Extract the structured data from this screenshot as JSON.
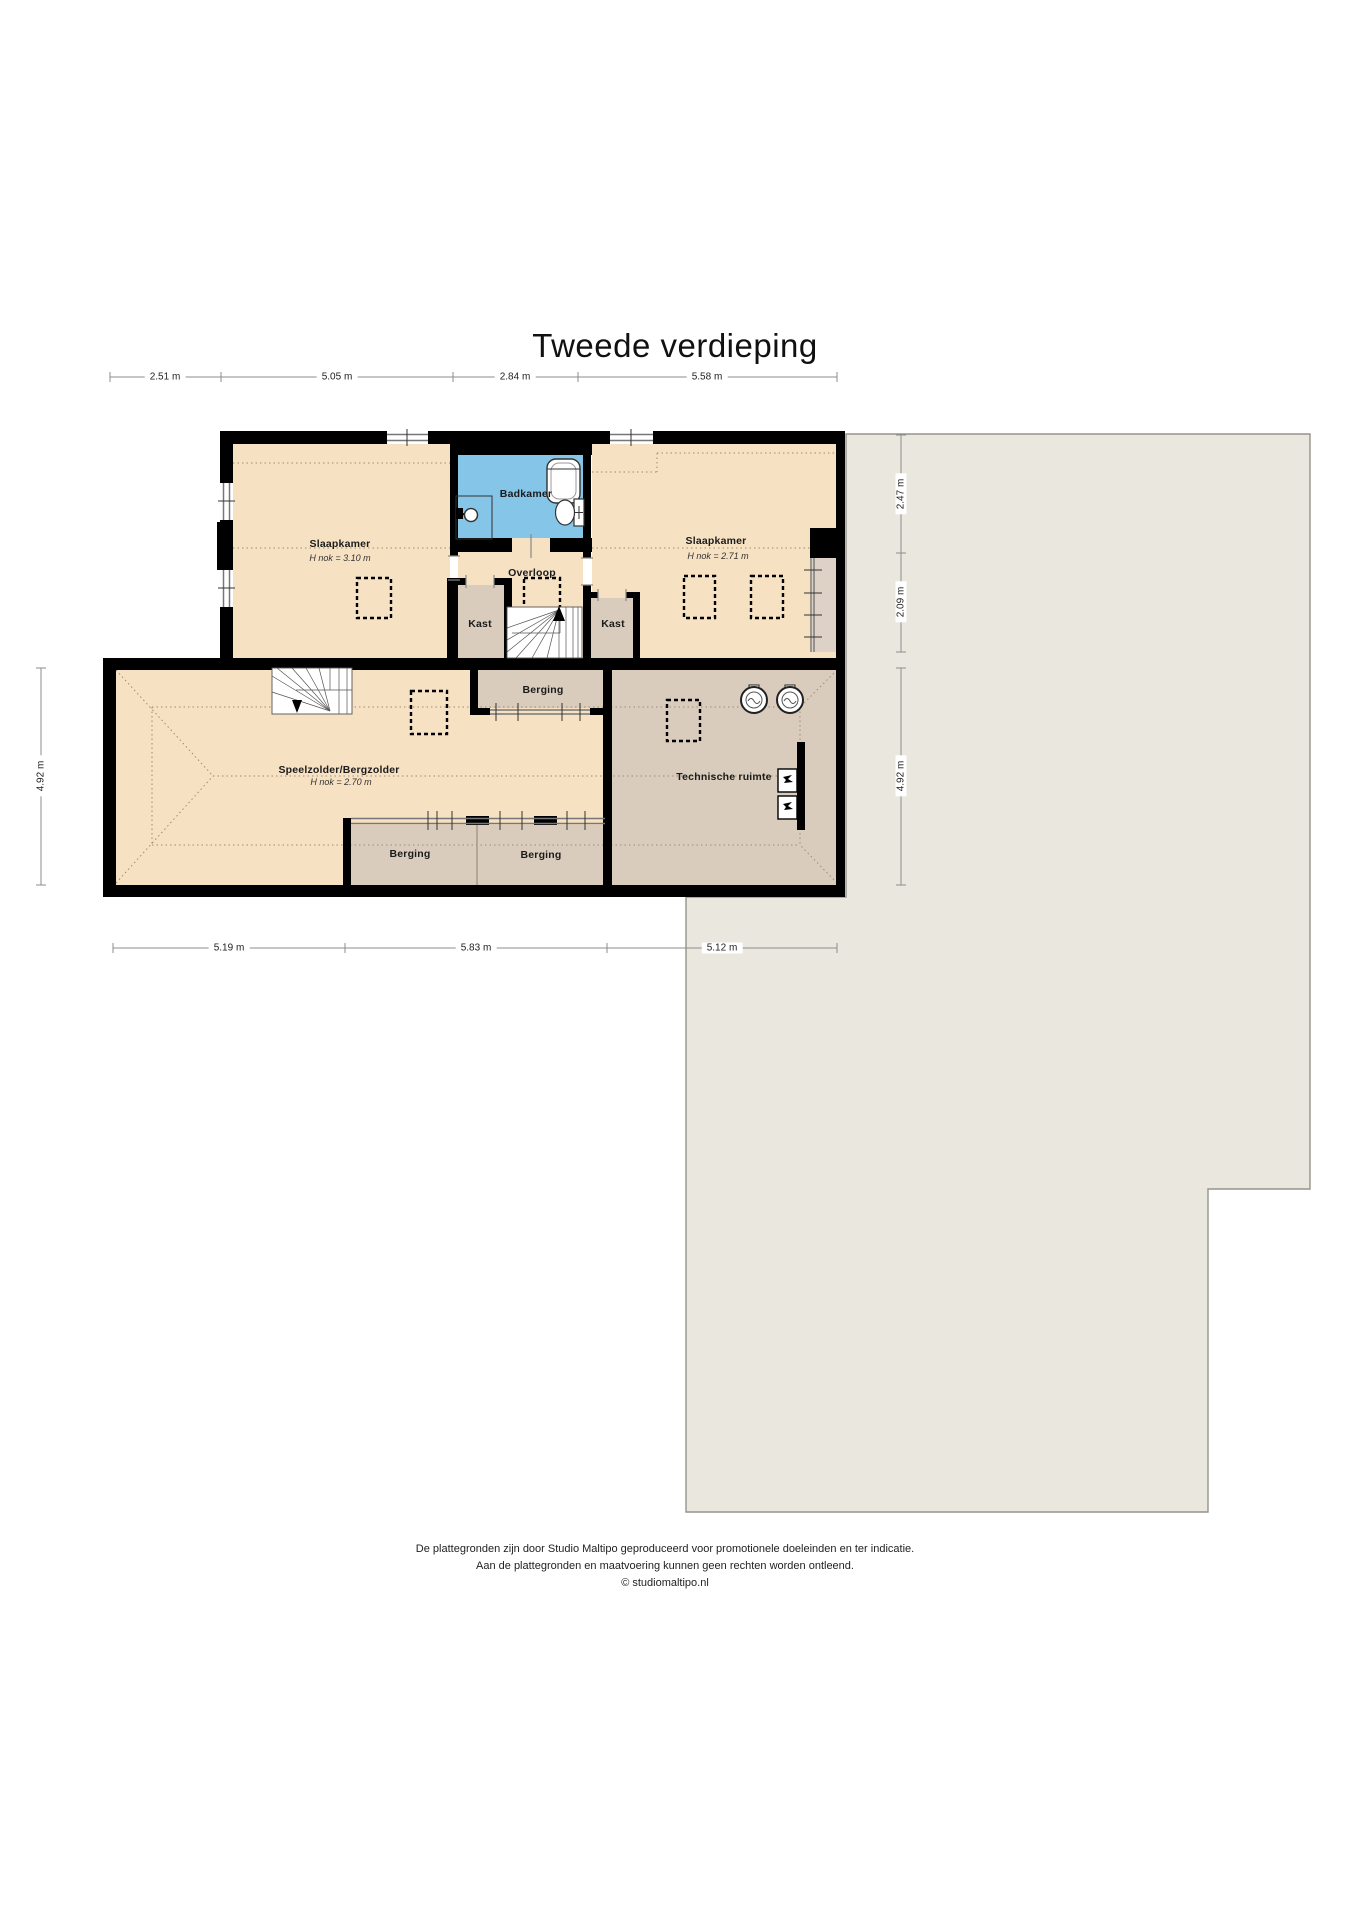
{
  "title": "Tweede verdieping",
  "plan": {
    "rooms": {
      "slaapkamer_left": {
        "label": "Slaapkamer",
        "height_note": "H nok = 3.10 m"
      },
      "badkamer": {
        "label": "Badkamer"
      },
      "slaapkamer_right": {
        "label": "Slaapkamer",
        "height_note": "H nok = 2.71 m"
      },
      "overloop": {
        "label": "Overloop"
      },
      "kast_left": {
        "label": "Kast"
      },
      "kast_right": {
        "label": "Kast"
      },
      "berging_top": {
        "label": "Berging"
      },
      "speelzolder": {
        "label": "Speelzolder/Bergzolder",
        "height_note": "H nok = 2.70 m"
      },
      "berging_bottom_left": {
        "label": "Berging"
      },
      "berging_bottom_right": {
        "label": "Berging"
      },
      "technische_ruimte": {
        "label": "Technische ruimte"
      }
    },
    "dimensions": {
      "top": [
        "2.51 m",
        "5.05 m",
        "2.84 m",
        "5.58 m"
      ],
      "bottom": [
        "5.19 m",
        "5.83 m",
        "5.12 m"
      ],
      "left": [
        "4.92 m"
      ],
      "right": [
        "2.47 m",
        "2.09 m",
        "4.92 m"
      ]
    },
    "colors": {
      "room_beige": "#f6e1c3",
      "room_tan": "#d9ccbd",
      "knee_tan": "#ddd2c5",
      "bathroom_blue": "#85c6e8",
      "roof_gray": "#eae7df",
      "wall_black": "#000000"
    }
  },
  "footer": {
    "line1": "De plattegronden zijn door Studio Maltipo geproduceerd voor promotionele doeleinden en ter indicatie.",
    "line2": "Aan de plattegronden en maatvoering kunnen geen rechten worden ontleend.",
    "line3": "© studiomaltipo.nl"
  }
}
